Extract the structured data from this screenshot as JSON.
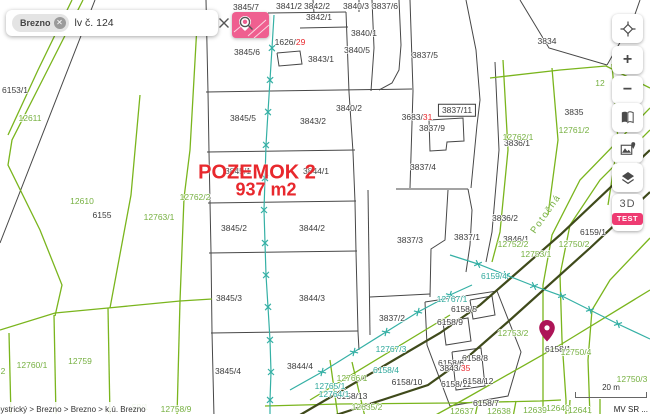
{
  "search": {
    "chip": "Brezno",
    "query": "lv č. 124"
  },
  "overlay": {
    "title": "POZEMOK 2",
    "area": "937 m2"
  },
  "street": "Potočná",
  "breadcrumb": {
    "path": "bystrický > Brezno > Brezno > k.ú. Brezno"
  },
  "attribution": "MV SR ...",
  "scale": "20 m",
  "controls": {
    "zoom_in": "+",
    "zoom_out": "−",
    "mode_3d": "3D",
    "test_badge": "TEST"
  },
  "colors": {
    "accent_pink": "#ef5f90",
    "badge_pink": "#ee3b72",
    "label_green": "#76b041",
    "label_teal": "#2fa89c",
    "label_red": "#e8282d",
    "line_dark": "#474747",
    "line_green": "#7ab51d",
    "line_road": "#3f4a1b",
    "line_teal": "#35b0a5",
    "marker_purple": "#ad1457"
  },
  "map": {
    "labels": {
      "black": [
        {
          "t": "3845/7",
          "x": 246,
          "y": 7
        },
        {
          "t": "3841/2",
          "x": 289,
          "y": 6
        },
        {
          "t": "3842/2",
          "x": 317,
          "y": 6
        },
        {
          "t": "3842/1",
          "x": 319,
          "y": 17
        },
        {
          "t": "3840/3",
          "x": 356,
          "y": 6
        },
        {
          "t": "3837/6",
          "x": 385,
          "y": 6
        },
        {
          "t": "3840/1",
          "x": 364,
          "y": 33
        },
        {
          "t": "3840/5",
          "x": 357,
          "y": 50
        },
        {
          "t": "3845/6",
          "x": 247,
          "y": 52
        },
        {
          "t": "3843/1",
          "x": 321,
          "y": 59
        },
        {
          "t": "3840/2",
          "x": 349,
          "y": 108
        },
        {
          "t": "3845/5",
          "x": 243,
          "y": 118
        },
        {
          "t": "3843/2",
          "x": 313,
          "y": 121
        },
        {
          "t": "3837/5",
          "x": 425,
          "y": 55
        },
        {
          "t": "3837/11",
          "x": 457,
          "y": 110,
          "boxed": true
        },
        {
          "t": "3837/9",
          "x": 432,
          "y": 128
        },
        {
          "t": "3837/4",
          "x": 423,
          "y": 167
        },
        {
          "t": "3834",
          "x": 547,
          "y": 41
        },
        {
          "t": "3835",
          "x": 574,
          "y": 112
        },
        {
          "t": "3836/1",
          "x": 517,
          "y": 143
        },
        {
          "t": "3836/2",
          "x": 505,
          "y": 218
        },
        {
          "t": "3837/3",
          "x": 410,
          "y": 240
        },
        {
          "t": "3837/1",
          "x": 467,
          "y": 237
        },
        {
          "t": "3846/1",
          "x": 516,
          "y": 239
        },
        {
          "t": "3837/2",
          "x": 392,
          "y": 318
        },
        {
          "t": "6153/1",
          "x": 15,
          "y": 90
        },
        {
          "t": "6155",
          "x": 102,
          "y": 215
        },
        {
          "t": "6159/1",
          "x": 593,
          "y": 232
        },
        {
          "t": "3845/1",
          "x": 238,
          "y": 171
        },
        {
          "t": "3844/1",
          "x": 316,
          "y": 171
        },
        {
          "t": "3845/2",
          "x": 234,
          "y": 228
        },
        {
          "t": "3844/2",
          "x": 312,
          "y": 228
        },
        {
          "t": "3845/3",
          "x": 229,
          "y": 298
        },
        {
          "t": "3844/3",
          "x": 312,
          "y": 298
        },
        {
          "t": "3845/4",
          "x": 228,
          "y": 371
        },
        {
          "t": "3844/4",
          "x": 300,
          "y": 366
        },
        {
          "t": "6158/1",
          "x": 558,
          "y": 349
        },
        {
          "t": "6158/10",
          "x": 407,
          "y": 382
        },
        {
          "t": "6158/5",
          "x": 464,
          "y": 309
        },
        {
          "t": "6158/9",
          "x": 450,
          "y": 322
        },
        {
          "t": "6158/8",
          "x": 475,
          "y": 358
        },
        {
          "t": "6158/6",
          "x": 451,
          "y": 363
        },
        {
          "t": "6158/11",
          "x": 456,
          "y": 384
        },
        {
          "t": "6158/12",
          "x": 478,
          "y": 381
        },
        {
          "t": "6158/7",
          "x": 486,
          "y": 403
        },
        {
          "t": "6158/13",
          "x": 352,
          "y": 396
        }
      ],
      "green": [
        {
          "t": "12611",
          "x": 30,
          "y": 118
        },
        {
          "t": "12610",
          "x": 82,
          "y": 201
        },
        {
          "t": "12763/1",
          "x": 159,
          "y": 217
        },
        {
          "t": "12762/2",
          "x": 195,
          "y": 197
        },
        {
          "t": "12762/1",
          "x": 518,
          "y": 137
        },
        {
          "t": "12761/2",
          "x": 574,
          "y": 130
        },
        {
          "t": "12752/2",
          "x": 513,
          "y": 244
        },
        {
          "t": "12753/1",
          "x": 536,
          "y": 254
        },
        {
          "t": "12750/2",
          "x": 574,
          "y": 244
        },
        {
          "t": "12753/2",
          "x": 513,
          "y": 333
        },
        {
          "t": "12750/4",
          "x": 576,
          "y": 352
        },
        {
          "t": "12750/3",
          "x": 632,
          "y": 379
        },
        {
          "t": "12760/1",
          "x": 32,
          "y": 365
        },
        {
          "t": "12759",
          "x": 80,
          "y": 361
        },
        {
          "t": "12766/1",
          "x": 352,
          "y": 378
        },
        {
          "t": "12635/2",
          "x": 367,
          "y": 407
        },
        {
          "t": "12637",
          "x": 462,
          "y": 411
        },
        {
          "t": "12638",
          "x": 499,
          "y": 411
        },
        {
          "t": "12639",
          "x": 535,
          "y": 410
        },
        {
          "t": "12640",
          "x": 558,
          "y": 408
        },
        {
          "t": "12641",
          "x": 580,
          "y": 410
        },
        {
          "t": "2",
          "x": 3,
          "y": 371
        },
        {
          "t": "12",
          "x": 600,
          "y": 83
        },
        {
          "t": "58/1",
          "x": 140,
          "y": 407
        },
        {
          "t": "12758/9",
          "x": 176,
          "y": 409
        }
      ],
      "teal": [
        {
          "t": "12767/1",
          "x": 452,
          "y": 299
        },
        {
          "t": "12767/3",
          "x": 391,
          "y": 349
        },
        {
          "t": "6158/4",
          "x": 386,
          "y": 370
        },
        {
          "t": "12765/1",
          "x": 330,
          "y": 386
        },
        {
          "t": "12764/1",
          "x": 334,
          "y": 394
        },
        {
          "t": "6159/4",
          "x": 494,
          "y": 276
        }
      ],
      "red": [
        {
          "pre": "1626/",
          "red": "29",
          "x": 290,
          "y": 42
        },
        {
          "pre": "3683/",
          "red": "31",
          "x": 417,
          "y": 117
        },
        {
          "pre": "3843/",
          "red": "35",
          "x": 455,
          "y": 368
        }
      ]
    }
  }
}
